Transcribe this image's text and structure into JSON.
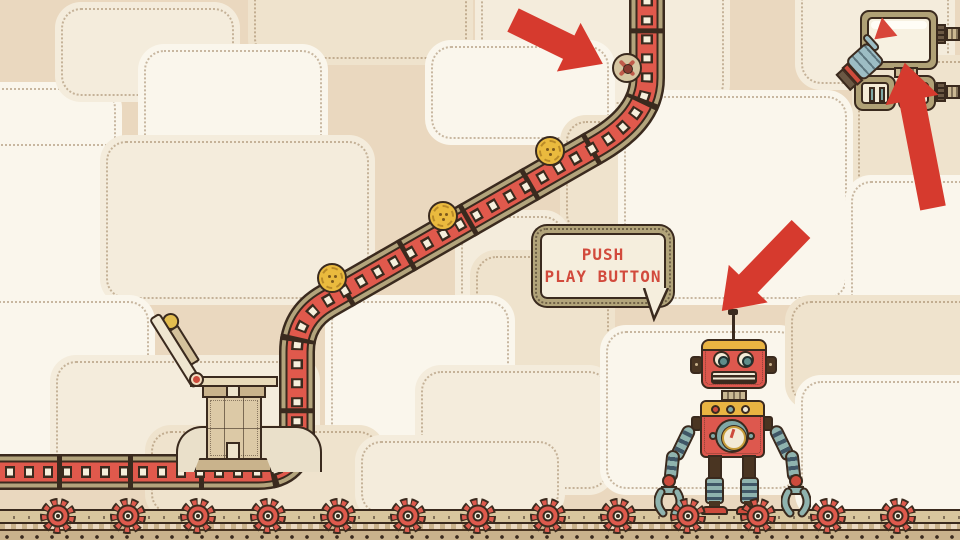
{
  "game": {
    "speech_bubble": {
      "line1": "PUSH",
      "line2": "PLAY BUTTON"
    },
    "counts": {
      "coins_visible": 3,
      "rail_gears": 13,
      "tutorial_arrows": 3
    },
    "icons": [
      "play-icon",
      "pause-icon",
      "gear-icon",
      "coin-icon",
      "arrow-icon",
      "wheel-button-icon"
    ],
    "colors": {
      "accent_red": "#d63a2e",
      "track_red": "#df5a4c",
      "khaki": "#b2a47b",
      "outline_brown": "#3a2a1e",
      "cream": "#f6efdc",
      "panel_light": "#faf6ec",
      "panel_cream": "#f4ecdc",
      "panel_tan": "#efe3cd",
      "base_tan": "#ead8bf",
      "coin_gold": "#eaba3e",
      "robot_red": "#dd584e",
      "robot_yellow": "#e9b442",
      "robot_teal": "#8fb3ae"
    }
  }
}
